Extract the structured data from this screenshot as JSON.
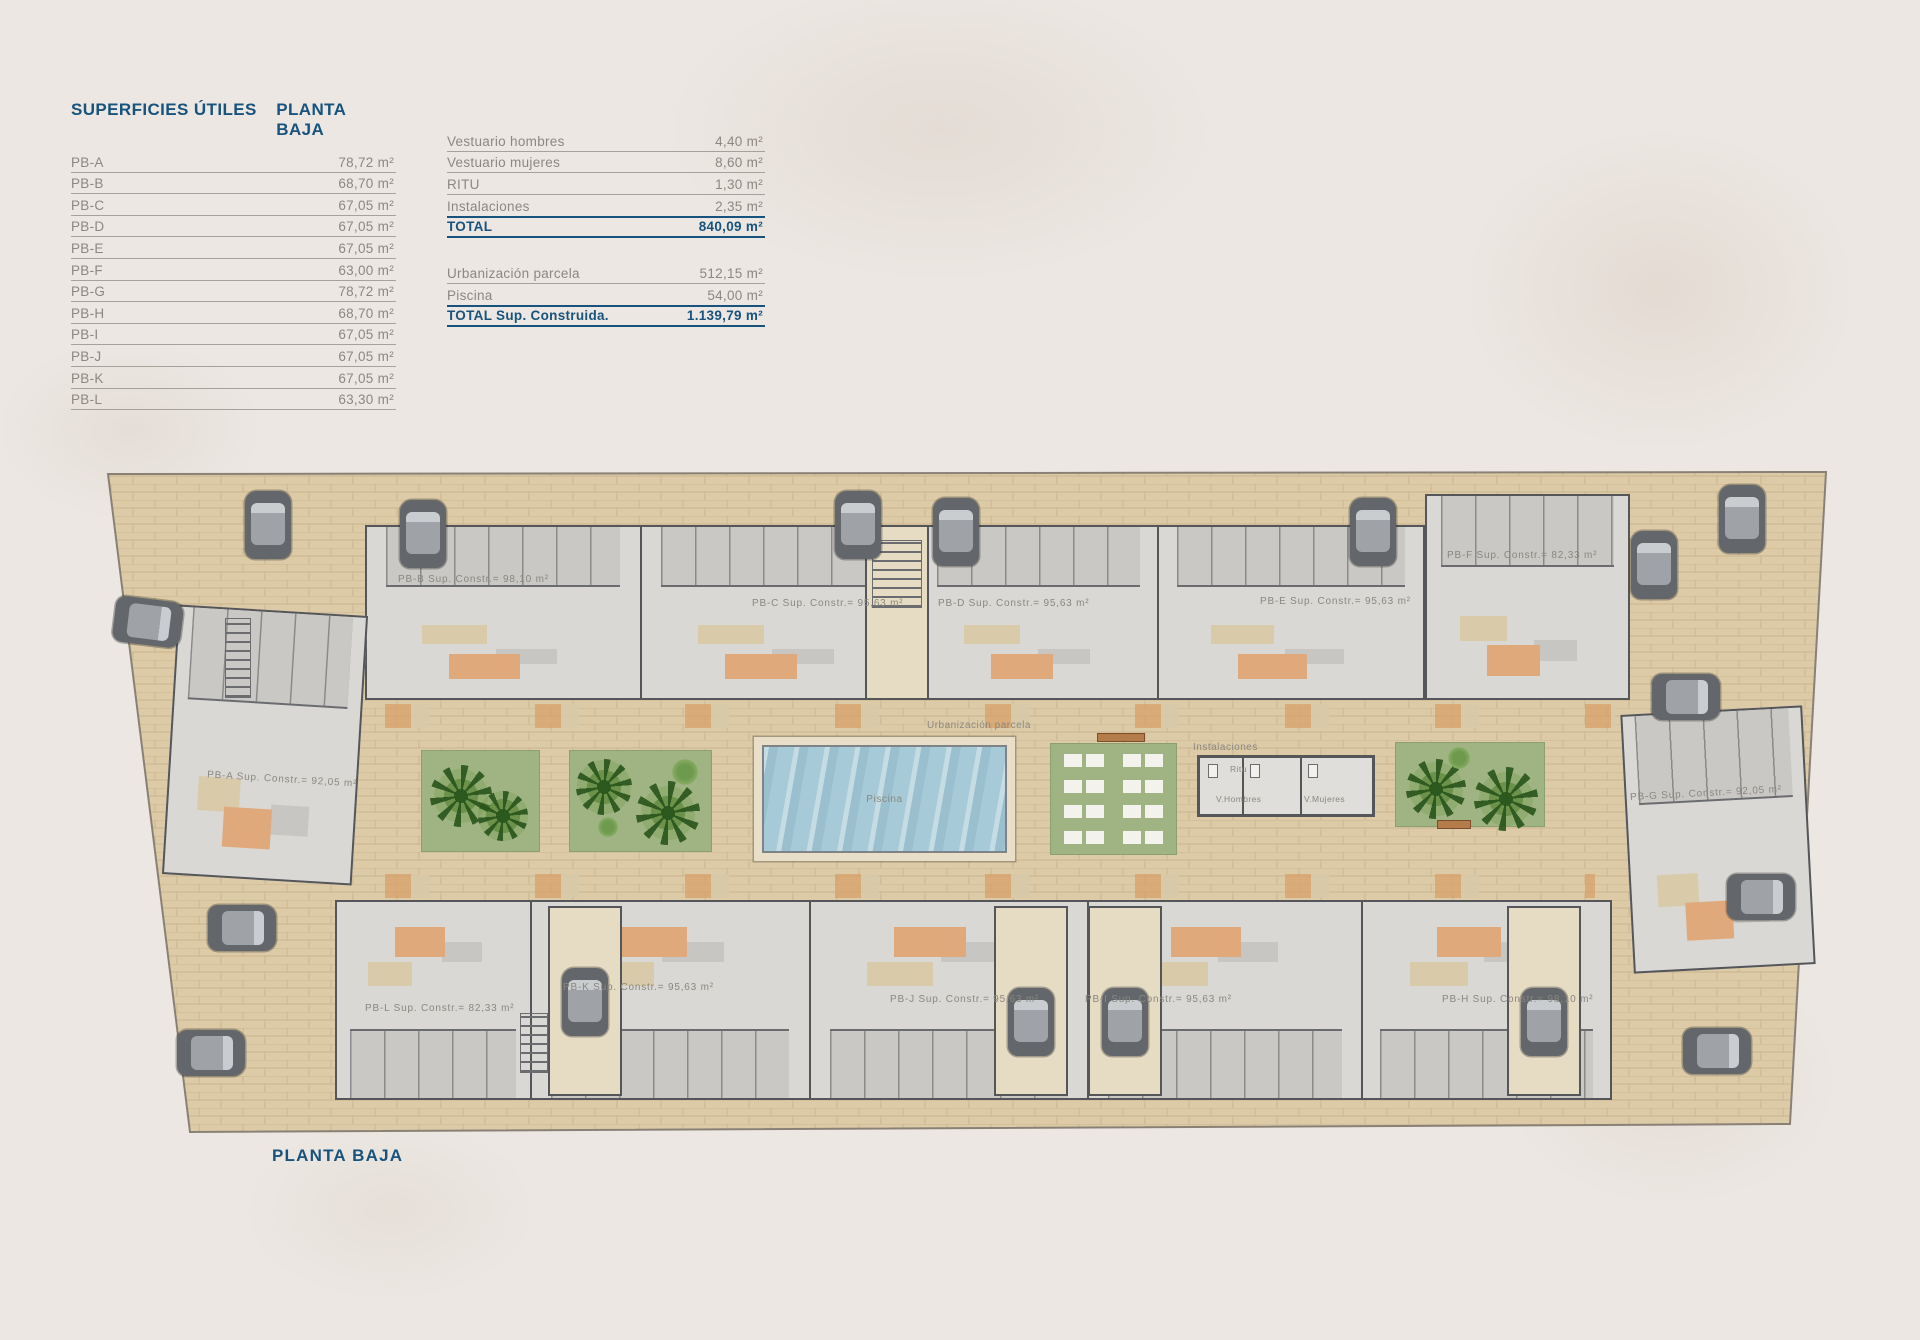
{
  "surfaces_table": {
    "title": "SUPERFICIES ÚTILES",
    "subtitle": "PLANTA BAJA",
    "rows": [
      {
        "label": "PB-A",
        "value": "78,72 m²"
      },
      {
        "label": "PB-B",
        "value": "68,70 m²"
      },
      {
        "label": "PB-C",
        "value": "67,05 m²"
      },
      {
        "label": "PB-D",
        "value": "67,05 m²"
      },
      {
        "label": "PB-E",
        "value": "67,05 m²"
      },
      {
        "label": "PB-F",
        "value": "63,00 m²"
      },
      {
        "label": "PB-G",
        "value": "78,72 m²"
      },
      {
        "label": "PB-H",
        "value": "68,70 m²"
      },
      {
        "label": "PB-I",
        "value": "67,05 m²"
      },
      {
        "label": "PB-J",
        "value": "67,05 m²"
      },
      {
        "label": "PB-K",
        "value": "67,05 m²"
      },
      {
        "label": "PB-L",
        "value": "63,30 m²"
      }
    ]
  },
  "common_areas_table": {
    "rows": [
      {
        "label": "Vestuario hombres",
        "value": "4,40 m²"
      },
      {
        "label": "Vestuario mujeres",
        "value": "8,60 m²"
      },
      {
        "label": "RITU",
        "value": "1,30 m²"
      },
      {
        "label": "Instalaciones",
        "value": "2,35 m²"
      }
    ],
    "total": {
      "label": "TOTAL",
      "value": "840,09 m²"
    }
  },
  "built_totals_table": {
    "rows": [
      {
        "label": "Urbanización parcela",
        "value": "512,15 m²"
      },
      {
        "label": "Piscina",
        "value": "54,00 m²"
      }
    ],
    "total": {
      "label": "TOTAL Sup. Construida.",
      "value": "1.139,79 m²"
    }
  },
  "plan": {
    "caption": "PLANTA BAJA",
    "unit_labels": [
      {
        "id": "PB-A",
        "text": "PB-A Sup. Constr.= 92,05 m²"
      },
      {
        "id": "PB-B",
        "text": "PB-B Sup. Constr.= 98,10 m²"
      },
      {
        "id": "PB-C",
        "text": "PB-C Sup. Constr.= 95,63 m²"
      },
      {
        "id": "PB-D",
        "text": "PB-D Sup. Constr.= 95,63 m²"
      },
      {
        "id": "PB-E",
        "text": "PB-E Sup. Constr.= 95,63 m²"
      },
      {
        "id": "PB-F",
        "text": "PB-F Sup. Constr.= 82,33 m²"
      },
      {
        "id": "PB-G",
        "text": "PB-G Sup. Constr.= 92,05 m²"
      },
      {
        "id": "PB-H",
        "text": "PB-H Sup. Constr.= 98,10 m²"
      },
      {
        "id": "PB-I",
        "text": "PB-I Sup. Constr.= 95,63 m²"
      },
      {
        "id": "PB-J",
        "text": "PB-J Sup. Constr.= 95,63 m²"
      },
      {
        "id": "PB-K",
        "text": "PB-K Sup. Constr.= 95,63 m²"
      },
      {
        "id": "PB-L",
        "text": "PB-L Sup. Constr.= 82,33 m²"
      }
    ],
    "area_labels": {
      "urbanizacion": "Urbanización parcela",
      "piscina": "Piscina",
      "instalaciones": "Instalaciones",
      "ritu": "Ritu",
      "v_hombres": "V.Hombres",
      "v_mujeres": "V.Mujeres"
    }
  },
  "colors": {
    "accent_blue": "#17537D",
    "text_grey": "#8C8780",
    "parcel_tan": "#DCCBA6",
    "garden_green": "#9FB383",
    "pool_blue": "#A6CAD7"
  }
}
